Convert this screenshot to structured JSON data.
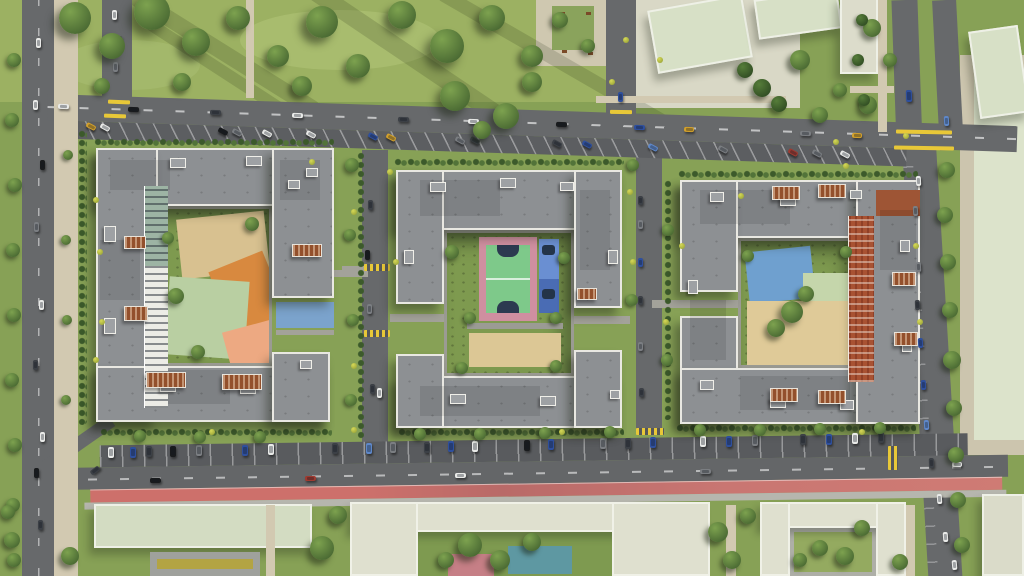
{
  "scene": {
    "title": "Aerial render of residential complex",
    "description": "Top-down 3D architectural visualization: three gray-roofed perimeter apartment blocks with landscaped courtyards (sand, orange and salmon playgrounds, green basketball court with pink border, blue sports pads), internal streets, tree-lined avenues with angled and perpendicular parking, a red bicycle lane along the bottom avenue, large lawns with trees at top-left, and pale low-rise context buildings along the top-right, right and bottom edges."
  },
  "palette": {
    "grass": "#87a156",
    "lawn": "#9cb162",
    "roof": "#8d9093",
    "road": "#67696b",
    "sidewalk": "#d2c9b1",
    "sand": "#d8c190",
    "orange": "#d8893f",
    "salmon": "#eda982",
    "court_green": "#7ec98a",
    "court_pink": "#cf8fa0",
    "court_blue": "#5d84c8",
    "bike_lane": "#c7706c",
    "pale_roof": "#d7e0c6",
    "brick": "#a85232",
    "car": {
      "white": "#e9eae8",
      "black": "#191b1d",
      "gray": "#7b7e82",
      "dark": "#3c4046",
      "blue": "#2e4f9d",
      "lblue": "#5e87c8",
      "yellow": "#d2a02c",
      "red": "#9e3a30"
    }
  },
  "trees": [
    [
      75,
      18,
      16
    ],
    [
      112,
      46,
      13
    ],
    [
      152,
      12,
      18
    ],
    [
      196,
      42,
      14
    ],
    [
      238,
      18,
      12
    ],
    [
      278,
      56,
      11
    ],
    [
      322,
      22,
      16
    ],
    [
      358,
      66,
      12
    ],
    [
      402,
      15,
      14
    ],
    [
      447,
      46,
      17
    ],
    [
      492,
      18,
      13
    ],
    [
      532,
      56,
      11
    ],
    [
      302,
      86,
      10
    ],
    [
      182,
      82,
      9
    ],
    [
      102,
      86,
      8
    ],
    [
      455,
      96,
      15
    ],
    [
      506,
      116,
      13
    ],
    [
      532,
      82,
      10
    ],
    [
      482,
      130,
      9
    ],
    [
      560,
      20,
      8
    ],
    [
      588,
      46,
      7
    ],
    [
      745,
      70,
      8,
      "d"
    ],
    [
      762,
      88,
      9,
      "d"
    ],
    [
      779,
      104,
      8,
      "d"
    ],
    [
      800,
      60,
      10
    ],
    [
      820,
      115,
      8
    ],
    [
      840,
      90,
      7
    ],
    [
      872,
      28,
      9
    ],
    [
      868,
      105,
      9
    ],
    [
      890,
      60,
      7
    ],
    [
      862,
      20,
      6,
      "d"
    ],
    [
      858,
      60,
      6,
      "d"
    ],
    [
      864,
      100,
      6,
      "d"
    ],
    [
      14,
      60,
      7
    ],
    [
      12,
      120,
      7
    ],
    [
      15,
      185,
      7
    ],
    [
      13,
      250,
      7
    ],
    [
      14,
      315,
      7
    ],
    [
      12,
      380,
      7
    ],
    [
      15,
      445,
      7
    ],
    [
      13,
      505,
      7
    ],
    [
      14,
      560,
      7
    ],
    [
      68,
      155,
      5
    ],
    [
      66,
      240,
      5
    ],
    [
      67,
      320,
      5
    ],
    [
      66,
      400,
      5
    ],
    [
      947,
      170,
      8
    ],
    [
      945,
      215,
      8
    ],
    [
      948,
      262,
      8
    ],
    [
      950,
      310,
      8
    ],
    [
      952,
      360,
      9
    ],
    [
      954,
      408,
      8
    ],
    [
      956,
      455,
      8
    ],
    [
      958,
      500,
      8
    ],
    [
      962,
      545,
      8
    ],
    [
      352,
      165,
      7
    ],
    [
      350,
      235,
      6
    ],
    [
      353,
      320,
      6
    ],
    [
      351,
      400,
      6
    ],
    [
      633,
      165,
      6
    ],
    [
      668,
      230,
      6
    ],
    [
      632,
      300,
      6
    ],
    [
      667,
      360,
      6
    ],
    [
      176,
      296,
      8
    ],
    [
      252,
      224,
      7
    ],
    [
      198,
      352,
      7
    ],
    [
      168,
      238,
      6
    ],
    [
      452,
      252,
      7
    ],
    [
      564,
      258,
      6
    ],
    [
      470,
      318,
      6
    ],
    [
      556,
      318,
      6
    ],
    [
      462,
      368,
      6
    ],
    [
      556,
      366,
      6
    ],
    [
      792,
      312,
      11
    ],
    [
      776,
      328,
      9
    ],
    [
      806,
      294,
      8
    ],
    [
      748,
      256,
      6
    ],
    [
      846,
      252,
      6
    ],
    [
      140,
      436,
      6
    ],
    [
      200,
      437,
      6
    ],
    [
      260,
      437,
      6
    ],
    [
      420,
      434,
      6
    ],
    [
      480,
      434,
      6
    ],
    [
      545,
      433,
      6
    ],
    [
      610,
      432,
      6
    ],
    [
      700,
      430,
      6
    ],
    [
      760,
      430,
      6
    ],
    [
      820,
      429,
      6
    ],
    [
      880,
      428,
      6
    ],
    [
      322,
      548,
      12
    ],
    [
      338,
      515,
      9
    ],
    [
      718,
      532,
      10
    ],
    [
      732,
      560,
      9
    ],
    [
      748,
      516,
      8
    ],
    [
      845,
      556,
      9
    ],
    [
      862,
      528,
      8
    ],
    [
      900,
      562,
      8
    ],
    [
      12,
      540,
      8
    ],
    [
      70,
      556,
      9
    ],
    [
      8,
      512,
      7
    ],
    [
      470,
      545,
      12
    ],
    [
      500,
      560,
      10
    ],
    [
      532,
      542,
      9
    ],
    [
      446,
      560,
      8
    ],
    [
      820,
      548,
      8
    ],
    [
      800,
      560,
      7
    ]
  ],
  "bushes": [
    [
      100,
      252
    ],
    [
      102,
      322
    ],
    [
      312,
      162
    ],
    [
      390,
      172
    ],
    [
      354,
      212
    ],
    [
      396,
      262
    ],
    [
      354,
      366
    ],
    [
      630,
      192
    ],
    [
      633,
      262
    ],
    [
      666,
      322
    ],
    [
      741,
      196
    ],
    [
      862,
      432
    ],
    [
      920,
      322
    ],
    [
      660,
      60
    ],
    [
      626,
      40
    ],
    [
      612,
      82
    ],
    [
      836,
      142
    ],
    [
      846,
      166
    ],
    [
      906,
      136
    ],
    [
      212,
      432
    ],
    [
      562,
      432
    ],
    [
      682,
      246
    ],
    [
      916,
      246
    ],
    [
      354,
      430
    ],
    [
      96,
      200
    ],
    [
      96,
      360
    ]
  ],
  "cars": [
    [
      58,
      104,
      11,
      5,
      "white",
      2
    ],
    [
      128,
      107,
      11,
      5,
      "black",
      2
    ],
    [
      210,
      110,
      11,
      5,
      "dark",
      2
    ],
    [
      292,
      113,
      11,
      5,
      "white",
      2
    ],
    [
      398,
      117,
      11,
      5,
      "dark",
      2
    ],
    [
      468,
      119,
      11,
      5,
      "white",
      2
    ],
    [
      556,
      122,
      11,
      5,
      "black",
      2
    ],
    [
      634,
      125,
      11,
      5,
      "blue",
      2
    ],
    [
      684,
      127,
      10,
      5,
      "yellow",
      2
    ],
    [
      800,
      131,
      11,
      5,
      "gray",
      2
    ],
    [
      852,
      133,
      10,
      5,
      "yellow",
      2
    ],
    [
      86,
      124,
      10,
      5,
      "yellow",
      28
    ],
    [
      100,
      125,
      10,
      5,
      "white",
      28
    ],
    [
      218,
      129,
      10,
      5,
      "black",
      28
    ],
    [
      232,
      130,
      10,
      5,
      "gray",
      28
    ],
    [
      262,
      131,
      10,
      5,
      "white",
      28
    ],
    [
      306,
      132,
      10,
      5,
      "white",
      28
    ],
    [
      368,
      134,
      10,
      5,
      "blue",
      28
    ],
    [
      386,
      135,
      10,
      5,
      "yellow",
      28
    ],
    [
      455,
      138,
      10,
      5,
      "gray",
      28
    ],
    [
      470,
      138,
      10,
      5,
      "dark",
      28
    ],
    [
      552,
      141,
      10,
      5,
      "dark",
      28
    ],
    [
      582,
      142,
      10,
      5,
      "blue",
      28
    ],
    [
      648,
      145,
      10,
      5,
      "lblue",
      28
    ],
    [
      718,
      147,
      10,
      5,
      "gray",
      28
    ],
    [
      788,
      150,
      10,
      5,
      "red",
      28
    ],
    [
      812,
      151,
      10,
      5,
      "gray",
      28
    ],
    [
      840,
      152,
      10,
      5,
      "white",
      28
    ],
    [
      112,
      10,
      5,
      10,
      "white",
      0
    ],
    [
      117,
      36,
      5,
      10,
      "dark",
      0
    ],
    [
      113,
      62,
      5,
      10,
      "gray",
      0
    ],
    [
      618,
      92,
      5,
      10,
      "blue",
      0
    ],
    [
      906,
      90,
      6,
      12,
      "blue",
      -2
    ],
    [
      944,
      116,
      5,
      10,
      "lblue",
      -3
    ],
    [
      36,
      38,
      5,
      10,
      "white",
      0
    ],
    [
      33,
      100,
      5,
      10,
      "white",
      0
    ],
    [
      40,
      160,
      5,
      10,
      "black",
      0
    ],
    [
      34,
      222,
      5,
      10,
      "gray",
      0
    ],
    [
      39,
      300,
      5,
      10,
      "white",
      0
    ],
    [
      33,
      360,
      5,
      10,
      "dark",
      0
    ],
    [
      40,
      432,
      5,
      10,
      "white",
      0
    ],
    [
      34,
      468,
      5,
      10,
      "black",
      0
    ],
    [
      38,
      520,
      5,
      10,
      "dark",
      0
    ],
    [
      368,
      200,
      5,
      10,
      "dark",
      0
    ],
    [
      365,
      250,
      5,
      10,
      "black",
      0
    ],
    [
      367,
      304,
      5,
      10,
      "gray",
      0
    ],
    [
      370,
      384,
      5,
      10,
      "dark",
      0
    ],
    [
      377,
      388,
      5,
      10,
      "white",
      0
    ],
    [
      638,
      196,
      5,
      9,
      "dark",
      0
    ],
    [
      638,
      220,
      5,
      9,
      "gray",
      0
    ],
    [
      638,
      258,
      5,
      9,
      "blue",
      0
    ],
    [
      638,
      296,
      5,
      9,
      "dark",
      0
    ],
    [
      638,
      342,
      5,
      9,
      "gray",
      0
    ],
    [
      639,
      388,
      5,
      9,
      "dark",
      0
    ],
    [
      916,
      176,
      5,
      10,
      "white",
      -3
    ],
    [
      913,
      206,
      5,
      10,
      "gray",
      -3
    ],
    [
      916,
      262,
      5,
      10,
      "gray",
      -3
    ],
    [
      915,
      300,
      5,
      10,
      "dark",
      -3
    ],
    [
      918,
      338,
      5,
      10,
      "blue",
      -3
    ],
    [
      921,
      380,
      5,
      10,
      "blue",
      -3
    ],
    [
      924,
      420,
      5,
      10,
      "lblue",
      -3
    ],
    [
      929,
      458,
      5,
      10,
      "dark",
      -3
    ],
    [
      937,
      494,
      5,
      10,
      "white",
      -4
    ],
    [
      943,
      532,
      5,
      10,
      "white",
      -4
    ],
    [
      108,
      447,
      6,
      11,
      "white",
      0
    ],
    [
      130,
      447,
      6,
      11,
      "blue",
      0
    ],
    [
      146,
      446,
      6,
      11,
      "dark",
      0
    ],
    [
      170,
      446,
      6,
      11,
      "black",
      0
    ],
    [
      196,
      445,
      6,
      11,
      "gray",
      0
    ],
    [
      242,
      445,
      6,
      11,
      "blue",
      0
    ],
    [
      268,
      444,
      6,
      11,
      "white",
      0
    ],
    [
      332,
      443,
      6,
      11,
      "dark",
      0
    ],
    [
      366,
      443,
      6,
      11,
      "lblue",
      0
    ],
    [
      390,
      442,
      6,
      11,
      "gray",
      0
    ],
    [
      424,
      442,
      6,
      11,
      "dark",
      0
    ],
    [
      448,
      441,
      6,
      11,
      "blue",
      0
    ],
    [
      472,
      441,
      6,
      11,
      "white",
      0
    ],
    [
      524,
      440,
      6,
      11,
      "black",
      0
    ],
    [
      548,
      439,
      6,
      11,
      "blue",
      0
    ],
    [
      600,
      438,
      6,
      11,
      "gray",
      0
    ],
    [
      625,
      438,
      6,
      11,
      "dark",
      0
    ],
    [
      650,
      437,
      6,
      11,
      "blue",
      0
    ],
    [
      700,
      436,
      6,
      11,
      "white",
      0
    ],
    [
      726,
      436,
      6,
      11,
      "blue",
      0
    ],
    [
      752,
      435,
      6,
      11,
      "gray",
      0
    ],
    [
      800,
      434,
      6,
      11,
      "dark",
      0
    ],
    [
      826,
      434,
      6,
      11,
      "blue",
      0
    ],
    [
      852,
      433,
      6,
      11,
      "white",
      0
    ],
    [
      878,
      432,
      6,
      11,
      "dark",
      0
    ],
    [
      150,
      478,
      11,
      5,
      "black",
      -1
    ],
    [
      305,
      476,
      11,
      5,
      "red",
      -1
    ],
    [
      455,
      473,
      11,
      5,
      "white",
      -1
    ],
    [
      700,
      469,
      11,
      5,
      "gray",
      -1
    ],
    [
      952,
      462,
      10,
      5,
      "white",
      -1
    ],
    [
      952,
      560,
      5,
      10,
      "white",
      -5
    ],
    [
      90,
      468,
      10,
      5,
      "dark",
      -38
    ]
  ],
  "paths": [
    [
      168,
      212,
      5,
      80,
      15
    ],
    [
      176,
      300,
      70,
      5,
      -28
    ],
    [
      230,
      230,
      5,
      90,
      40
    ],
    [
      190,
      345,
      70,
      5,
      12
    ],
    [
      446,
      324,
      128,
      5,
      0
    ],
    [
      390,
      314,
      54,
      8,
      0
    ],
    [
      574,
      316,
      56,
      8,
      0
    ],
    [
      330,
      270,
      38,
      7,
      0
    ],
    [
      342,
      266,
      24,
      7,
      0
    ],
    [
      742,
      252,
      5,
      112,
      -38
    ],
    [
      748,
      340,
      100,
      5,
      -18
    ],
    [
      752,
      256,
      112,
      5,
      20
    ],
    [
      800,
      242,
      5,
      122,
      30
    ],
    [
      652,
      300,
      88,
      8,
      0
    ],
    [
      276,
      330,
      58,
      5,
      0
    ],
    [
      246,
      0,
      8,
      98,
      0,
      "b"
    ],
    [
      596,
      96,
      190,
      7,
      0,
      "b"
    ],
    [
      700,
      238,
      62,
      6,
      0,
      "b"
    ],
    [
      878,
      0,
      9,
      132,
      0,
      "b"
    ],
    [
      850,
      86,
      44,
      7,
      0,
      "b"
    ],
    [
      266,
      505,
      9,
      71,
      0,
      "b"
    ],
    [
      726,
      505,
      10,
      71,
      0,
      "b"
    ],
    [
      906,
      505,
      9,
      71,
      0,
      "b"
    ]
  ],
  "hedges": [
    [
      94,
      138,
      240,
      8
    ],
    [
      394,
      158,
      230,
      8
    ],
    [
      678,
      170,
      240,
      8
    ],
    [
      78,
      130,
      9,
      295
    ],
    [
      100,
      428,
      232,
      9
    ],
    [
      398,
      428,
      226,
      9
    ],
    [
      676,
      424,
      240,
      9
    ],
    [
      357,
      152,
      7,
      288
    ],
    [
      664,
      180,
      7,
      240
    ]
  ],
  "pergolas": [
    [
      124,
      236,
      22,
      13
    ],
    [
      124,
      306,
      24,
      15
    ],
    [
      146,
      372,
      40,
      16
    ],
    [
      222,
      374,
      40,
      16
    ],
    [
      292,
      244,
      30,
      13
    ],
    [
      577,
      288,
      20,
      12
    ],
    [
      772,
      186,
      28,
      14
    ],
    [
      818,
      184,
      28,
      14
    ],
    [
      770,
      388,
      28,
      14
    ],
    [
      818,
      390,
      28,
      14
    ],
    [
      892,
      272,
      24,
      14
    ],
    [
      894,
      332,
      24,
      14
    ]
  ],
  "roof_boxes": [
    [
      170,
      158,
      16,
      10
    ],
    [
      246,
      156,
      16,
      10
    ],
    [
      306,
      168,
      12,
      9
    ],
    [
      104,
      226,
      12,
      16
    ],
    [
      104,
      318,
      12,
      16
    ],
    [
      160,
      382,
      16,
      10
    ],
    [
      240,
      384,
      16,
      10
    ],
    [
      288,
      180,
      12,
      9
    ],
    [
      300,
      360,
      12,
      9
    ],
    [
      430,
      182,
      16,
      10
    ],
    [
      500,
      178,
      16,
      10
    ],
    [
      560,
      182,
      14,
      9
    ],
    [
      404,
      250,
      10,
      14
    ],
    [
      608,
      250,
      10,
      14
    ],
    [
      450,
      394,
      16,
      10
    ],
    [
      540,
      396,
      16,
      10
    ],
    [
      610,
      390,
      10,
      9
    ],
    [
      710,
      192,
      14,
      10
    ],
    [
      780,
      196,
      16,
      10
    ],
    [
      850,
      190,
      12,
      9
    ],
    [
      688,
      280,
      10,
      14
    ],
    [
      700,
      380,
      14,
      10
    ],
    [
      770,
      398,
      16,
      10
    ],
    [
      840,
      400,
      14,
      10
    ],
    [
      900,
      240,
      10,
      12
    ],
    [
      902,
      340,
      10,
      12
    ]
  ],
  "roof_patches": [
    [
      110,
      160,
      60,
      30
    ],
    [
      100,
      240,
      40,
      60
    ],
    [
      150,
      370,
      80,
      34
    ],
    [
      280,
      160,
      40,
      40
    ],
    [
      420,
      180,
      80,
      36
    ],
    [
      580,
      190,
      30,
      80
    ],
    [
      420,
      386,
      120,
      30
    ],
    [
      700,
      190,
      90,
      34
    ],
    [
      690,
      300,
      36,
      60
    ],
    [
      740,
      376,
      110,
      34
    ],
    [
      880,
      210,
      36,
      60
    ]
  ],
  "markings": [
    [
      108,
      100,
      22,
      4,
      2,
      ""
    ],
    [
      104,
      114,
      22,
      4,
      2,
      ""
    ],
    [
      610,
      110,
      22,
      4,
      1,
      ""
    ],
    [
      896,
      130,
      56,
      4,
      1,
      ""
    ],
    [
      894,
      146,
      60,
      4,
      1,
      ""
    ],
    [
      364,
      264,
      26,
      7,
      0,
      "s"
    ],
    [
      364,
      330,
      26,
      7,
      0,
      "s"
    ],
    [
      888,
      446,
      10,
      24,
      0,
      "s"
    ],
    [
      636,
      428,
      28,
      7,
      0,
      "s"
    ]
  ],
  "benches": [
    [
      560,
      12
    ],
    [
      586,
      12
    ],
    [
      562,
      50
    ],
    [
      588,
      52
    ]
  ],
  "streaks": [
    [
      60,
      30,
      280,
      16,
      32
    ],
    [
      240,
      40,
      320,
      18,
      34
    ],
    [
      420,
      55,
      280,
      14,
      30
    ],
    [
      120,
      70,
      220,
      12,
      33
    ]
  ]
}
